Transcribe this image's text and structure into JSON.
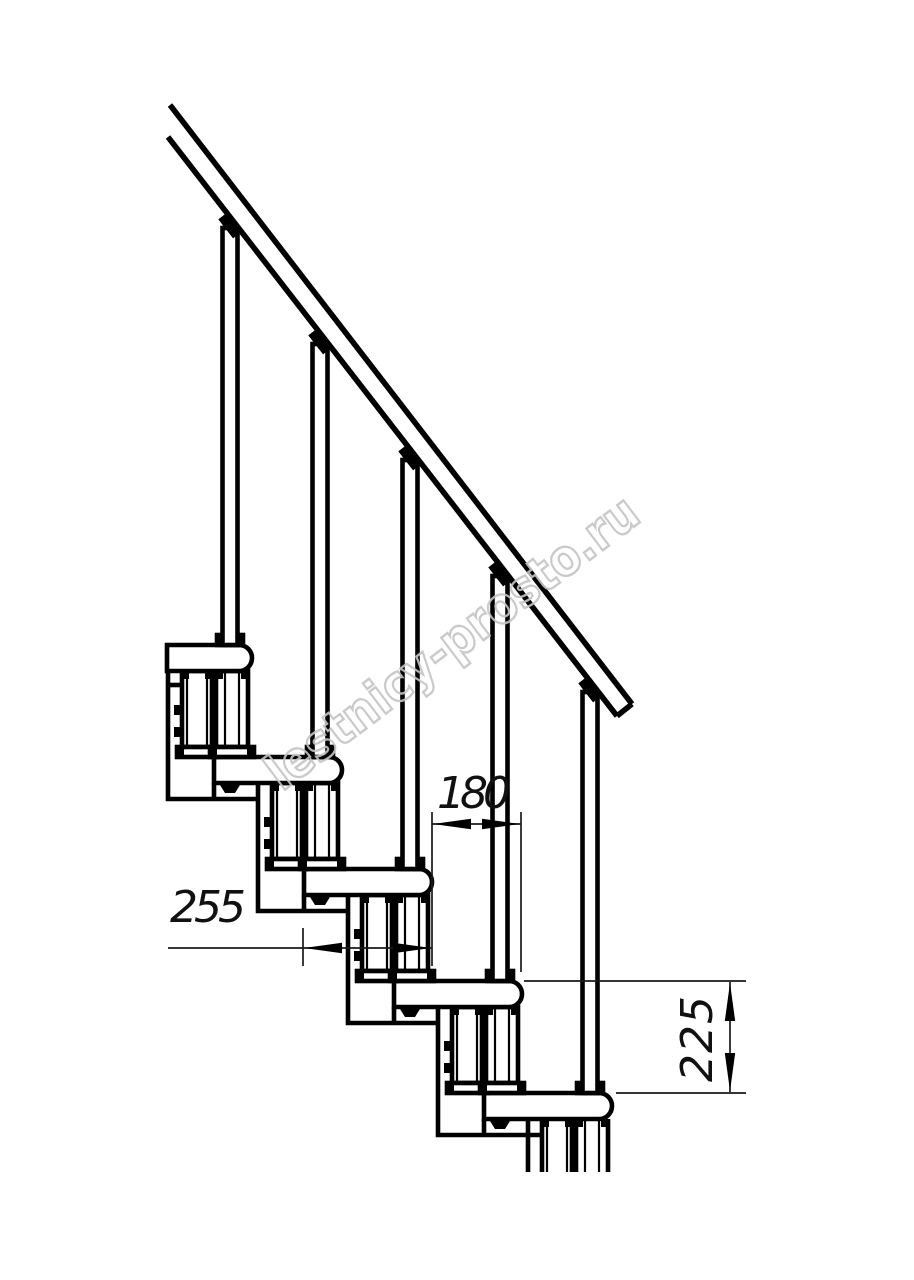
{
  "drawing": {
    "description": "Side-view technical drawing of a modular staircase section with handrail, balusters, treads and support modules",
    "background_color": "#ffffff",
    "line_color": "#000000"
  },
  "dimensions": {
    "step_run": "180",
    "tread_depth": "255",
    "step_rise": "225"
  },
  "watermark": {
    "text": "lestnicy-prosto.ru",
    "color": "#c5c5c5"
  }
}
